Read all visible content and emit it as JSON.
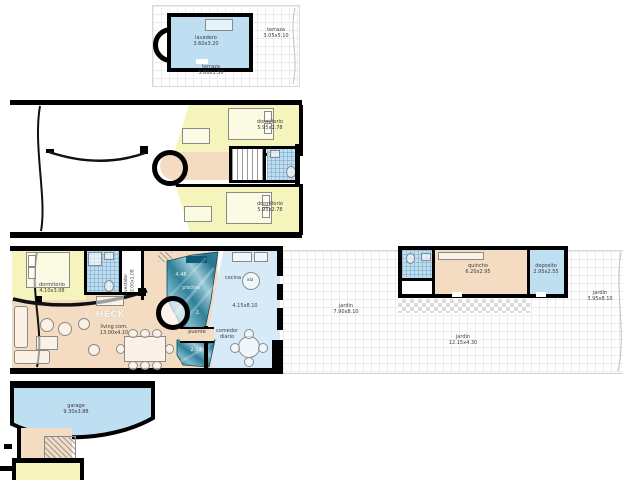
{
  "watermark": {
    "icon": "⊕",
    "text": "HECK"
  },
  "colors": {
    "room_yellow": "#f5f4bc",
    "room_blue": "#bedff2",
    "room_tan": "#f4dcc2",
    "kitchen_blue": "#d6eaf8",
    "pool_teal": "#2f8098",
    "wall": "#000000"
  },
  "roof_plan": {
    "lavadero": {
      "name": "lavadero",
      "dims": "3.60x3.20"
    },
    "terraza_side": {
      "name": "terraza",
      "dims": "3.05x5.10"
    },
    "terraza_front": {
      "name": "terraza",
      "dims": "5.80x1.50"
    }
  },
  "upper_plan": {
    "dormitorio_top": {
      "name": "dormitorio",
      "dims": "5.95x2.78"
    },
    "dormitorio_bottom": {
      "name": "dormitorio",
      "dims": "5.95x2.78"
    }
  },
  "main_plan": {
    "dormitorio": {
      "name": "dormitorio",
      "dims": "4.10x3.08"
    },
    "vestidor": {
      "name": "vestidor",
      "dims": "2.00x1.08"
    },
    "living": {
      "name": "living com.",
      "dims": "13.00x4.10"
    },
    "piscina": {
      "name": "piscina",
      "width": "4.48",
      "mark": "2.",
      "length": "2.04"
    },
    "puente": {
      "name": "puente"
    },
    "cocina": {
      "name": "cocina",
      "dims": "4.15x8.10"
    },
    "isla": {
      "name": "isla"
    },
    "comedor": {
      "name": "comedor diario"
    },
    "jardin_patio": {
      "name": "jardin",
      "dims": "7.90x8.10"
    },
    "jardin_lateral": {
      "name": "jardin",
      "dims": "12.15x4.30"
    },
    "jardin_fondo": {
      "name": "jardin",
      "dims": "3.95x8.10"
    },
    "quincho": {
      "name": "quincho",
      "dims": "6.20x2.95"
    },
    "deposito": {
      "name": "deposito",
      "dims": "2.95x2.55"
    }
  },
  "garage_plan": {
    "garage": {
      "name": "garage",
      "dims": "9.30x3.88"
    }
  }
}
